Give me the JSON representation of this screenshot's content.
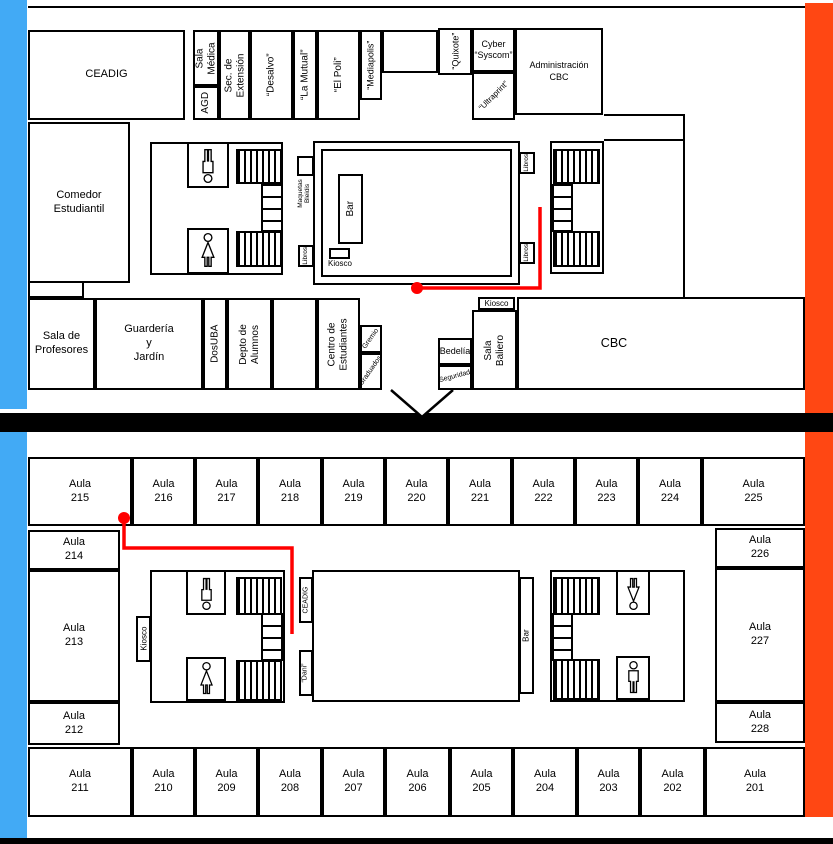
{
  "title": "Plano del edificio CBC - dos plantas",
  "colors": {
    "wing_left": "#42aaf5",
    "wing_right": "#ff4713",
    "route": "#ff0000",
    "walls": "#000000",
    "background": "#ffffff"
  },
  "floor1": {
    "top_row": {
      "ceadig": "CEADIG",
      "sala_medica": "Sala\nMédica",
      "agd": "AGD",
      "sec_extension": "Sec. de\nExtensión",
      "desalvo": "“Desalvo”",
      "la_mutual": "“La Mutual”",
      "el_poli": "“El Poli”",
      "mediapolis": "“Mediapolis”",
      "quixote": "“Quixote”",
      "cyber_syscom": "Cyber\n“Syscom”",
      "ultraprint": "“Ultraprint”",
      "administracion_cbc": "Administración\nCBC"
    },
    "left": {
      "comedor": "Comedor\nEstudiantil"
    },
    "center": {
      "bar": "Bar",
      "kiosco": "Kiosco",
      "libros": "Libros",
      "maquetas": "Maquetas\nBleidis"
    },
    "bottom_row": {
      "sala_profesores": "Sala de\nProfesores",
      "guarderia": "Guardería\ny\nJardín",
      "dosuba": "DosUBA",
      "depto_alumnos": "Depto de\nAlumnos",
      "centro_estudiantes": "Centro de\nEstudiantes",
      "gremio": "Gremio",
      "graduados": "Graduados"
    },
    "right": {
      "bedelia": "Bedelía",
      "seguridad": "Seguridad",
      "kiosco": "Kiosco",
      "sala_baliero": "Sala\nBaliero",
      "cbc": "CBC"
    }
  },
  "floor2": {
    "labels": {
      "kiosco": "Kiosco",
      "ceadig": "CEADIG",
      "dani": "“Dani”",
      "bar": "Bar"
    },
    "aulas_top": [
      "Aula\n215",
      "Aula\n216",
      "Aula\n217",
      "Aula\n218",
      "Aula\n219",
      "Aula\n220",
      "Aula\n221",
      "Aula\n222",
      "Aula\n223",
      "Aula\n224",
      "Aula\n225"
    ],
    "aulas_left": [
      "Aula\n214",
      "Aula\n213",
      "Aula\n212"
    ],
    "aulas_right": [
      "Aula\n226",
      "Aula\n227",
      "Aula\n228"
    ],
    "aulas_bottom": [
      "Aula\n211",
      "Aula\n210",
      "Aula\n209",
      "Aula\n208",
      "Aula\n207",
      "Aula\n206",
      "Aula\n205",
      "Aula\n204",
      "Aula\n203",
      "Aula\n202",
      "Aula\n201"
    ]
  }
}
